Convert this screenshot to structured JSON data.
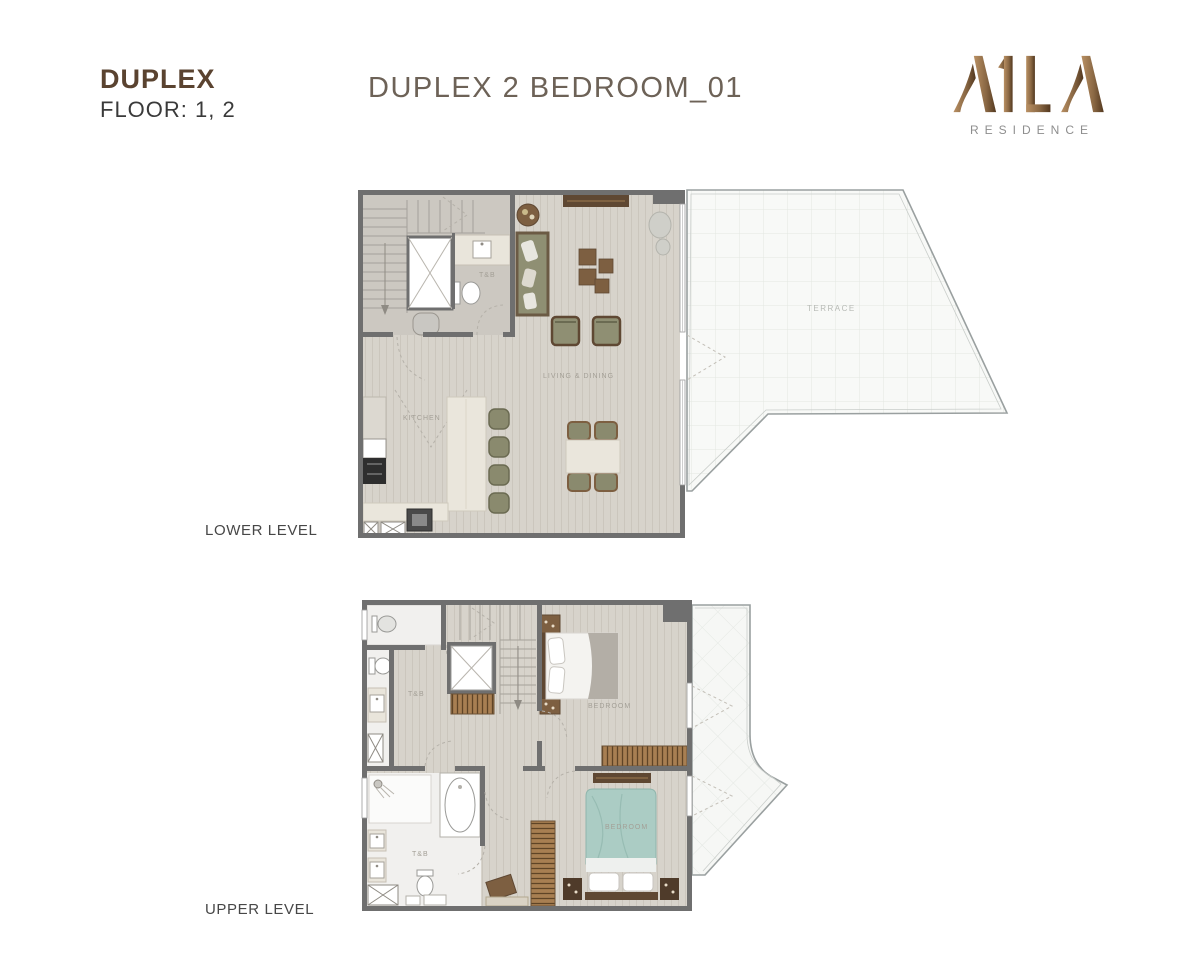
{
  "header": {
    "plan_type": "DUPLEX",
    "floor": "FLOOR: 1, 2",
    "title": "DUPLEX 2 BEDROOM_01"
  },
  "logo": {
    "name": "A1LA",
    "subtitle": "RESIDENCE"
  },
  "levels": {
    "lower": {
      "label": "LOWER LEVEL",
      "rooms": {
        "living_dining": "LIVING & DINING",
        "kitchen": "KITCHEN",
        "bath": "T&B",
        "terrace": "TERRACE"
      }
    },
    "upper": {
      "label": "UPPER LEVEL",
      "rooms": {
        "bedroom1": "BEDROOM",
        "bedroom2": "BEDROOM",
        "bath1": "T&B",
        "bath2": "T&B"
      }
    }
  },
  "palette": {
    "brand_bronze": "#8a6844",
    "heading_brown": "#5a4330",
    "title_gray_brown": "#6d6257",
    "text_dark": "#3a3a3a",
    "wall_gray": "#6f6f6f",
    "floor_wood": "#d7d3cb",
    "floor_bath": "#f1f0ee",
    "terrace_white": "#f8f9f7",
    "furniture_olive": "#8f8f73",
    "furniture_wood": "#7d5f41",
    "bed_teal": "#abccc4"
  }
}
